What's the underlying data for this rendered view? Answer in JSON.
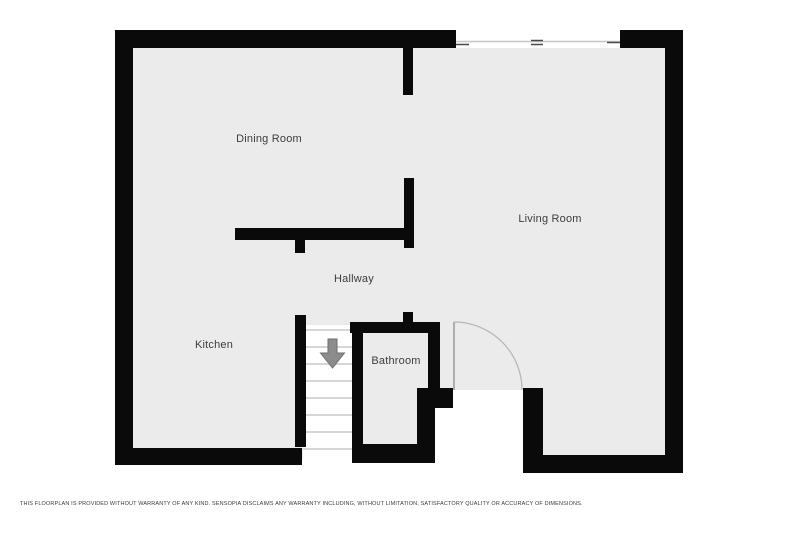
{
  "floorplan": {
    "canvas": {
      "width": 800,
      "height": 533
    },
    "colors": {
      "background": "#ffffff",
      "floor": "#ebebeb",
      "wall": "#0a0a0a",
      "label": "#3d3d3d",
      "stair_tread": "#c9c9c9",
      "stair_arrow_fill": "#8c8c8c",
      "stair_arrow_stroke": "#6e6e6e",
      "door_leaf": "#9a9a9a",
      "door_arc": "#b5b5b5",
      "window_line": "#c6c6c6",
      "window_tick": "#4a4a4a"
    },
    "rooms": [
      {
        "id": "dining-room",
        "label": "Dining Room",
        "cx": 269,
        "cy": 139
      },
      {
        "id": "living-room",
        "label": "Living Room",
        "cx": 550,
        "cy": 219
      },
      {
        "id": "hallway",
        "label": "Hallway",
        "cx": 354,
        "cy": 279
      },
      {
        "id": "kitchen",
        "label": "Kitchen",
        "cx": 214,
        "cy": 345
      },
      {
        "id": "bathroom",
        "label": "Bathroom",
        "cx": 396,
        "cy": 361
      }
    ],
    "floor_rects": [
      {
        "name": "floor-main",
        "x": 125,
        "y": 40,
        "w": 548,
        "h": 420
      }
    ],
    "white_rects": [
      {
        "name": "window-gap",
        "x": 455,
        "y": 29,
        "w": 166,
        "h": 19
      },
      {
        "name": "stairwell",
        "x": 303,
        "y": 325,
        "w": 49,
        "h": 138
      },
      {
        "name": "entry-opening",
        "x": 435,
        "y": 390,
        "w": 88,
        "h": 85
      }
    ],
    "walls": [
      {
        "name": "exterior-top-left",
        "x": 115,
        "y": 30,
        "w": 341,
        "h": 18
      },
      {
        "name": "exterior-top-right",
        "x": 620,
        "y": 30,
        "w": 63,
        "h": 18
      },
      {
        "name": "exterior-left",
        "x": 115,
        "y": 30,
        "w": 18,
        "h": 435
      },
      {
        "name": "exterior-right",
        "x": 665,
        "y": 30,
        "w": 18,
        "h": 443
      },
      {
        "name": "exterior-bottom-kitchen",
        "x": 115,
        "y": 448,
        "w": 187,
        "h": 17
      },
      {
        "name": "exterior-bottom-living",
        "x": 523,
        "y": 455,
        "w": 160,
        "h": 18
      },
      {
        "name": "living-entry-side",
        "x": 523,
        "y": 388,
        "w": 20,
        "h": 85
      },
      {
        "name": "dining-living-stub-top",
        "x": 403,
        "y": 48,
        "w": 10,
        "h": 47
      },
      {
        "name": "hallway-vertical",
        "x": 404,
        "y": 178,
        "w": 10,
        "h": 70
      },
      {
        "name": "hallway-horizontal",
        "x": 235,
        "y": 228,
        "w": 178,
        "h": 12
      },
      {
        "name": "hallway-stub-down",
        "x": 295,
        "y": 240,
        "w": 10,
        "h": 13
      },
      {
        "name": "stairs-left-wall",
        "x": 295,
        "y": 315,
        "w": 11,
        "h": 132
      },
      {
        "name": "stairs-right-wall",
        "x": 352,
        "y": 322,
        "w": 11,
        "h": 141
      },
      {
        "name": "bathroom-top-wall",
        "x": 350,
        "y": 322,
        "w": 90,
        "h": 11
      },
      {
        "name": "bathroom-top-stub",
        "x": 403,
        "y": 312,
        "w": 10,
        "h": 10
      },
      {
        "name": "bathroom-right-wall",
        "x": 428,
        "y": 322,
        "w": 12,
        "h": 68
      },
      {
        "name": "entry-hinge-stub",
        "x": 417,
        "y": 388,
        "w": 36,
        "h": 20
      },
      {
        "name": "bathroom-right-lower",
        "x": 417,
        "y": 408,
        "w": 18,
        "h": 55
      },
      {
        "name": "bathroom-bottom-wall",
        "x": 352,
        "y": 444,
        "w": 83,
        "h": 19
      }
    ],
    "window": {
      "line": {
        "x1": 456,
        "y1": 41.5,
        "x2": 620,
        "y2": 41.5
      },
      "ticks": [
        {
          "x1": 456,
          "y1": 44.5,
          "x2": 469,
          "y2": 44.5
        },
        {
          "x1": 607,
          "y1": 42.5,
          "x2": 620,
          "y2": 42.5
        },
        {
          "x1": 531,
          "y1": 40.5,
          "x2": 543,
          "y2": 40.5
        },
        {
          "x1": 531,
          "y1": 44.5,
          "x2": 543,
          "y2": 44.5
        }
      ]
    },
    "door": {
      "leaf": {
        "x1": 454,
        "y1": 322,
        "x2": 454,
        "y2": 390
      },
      "arc_path": "M454,322 A68,68 0 0 1 522,390"
    },
    "stairs": {
      "direction": "down",
      "tread_x1": 303,
      "tread_x2": 352,
      "tread_ys": [
        330,
        347,
        364,
        381,
        398,
        415,
        432,
        449
      ],
      "arrow_points": "328,339 337,339 337,353 344.5,353 332.5,368 320.5,353 328,353"
    },
    "disclaimer": {
      "text": "THIS FLOORPLAN IS PROVIDED WITHOUT WARRANTY OF ANY KIND. SENSOPIA DISCLAIMS ANY WARRANTY INCLUDING, WITHOUT LIMITATION, SATISFACTORY QUALITY OR ACCURACY OF DIMENSIONS."
    }
  }
}
